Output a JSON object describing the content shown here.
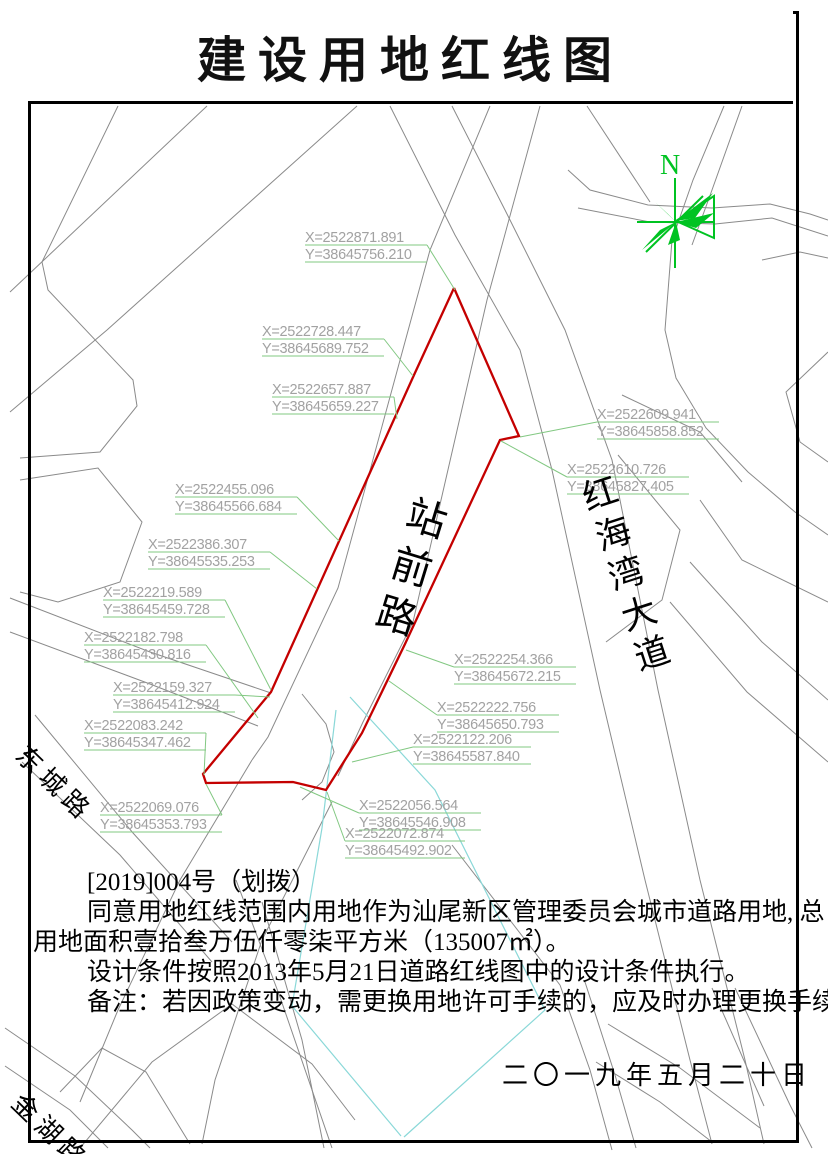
{
  "title": "建设用地红线图",
  "compass": {
    "label": "N"
  },
  "notes": {
    "lines": [
      "[2019]004号（划拨）",
      "同意用地红线范围内用地作为汕尾新区管理委员会城市道路用地, 总",
      "用地面积壹拾叁万伍仟零柒平方米（135007㎡）。",
      "设计条件按照2013年5月21日道路红线图中的设计条件执行。",
      "备注：若因政策变动，需更换用地许可手续的，应及时办理更换手续。"
    ]
  },
  "date": "二〇一九年五月二十日",
  "map": {
    "road_names": {
      "zhanqian": "站前路",
      "honghaiwan": "红海湾大道",
      "dongcheng": "东城路",
      "jinhu": "金湖路"
    },
    "colors": {
      "boundary_red": "#c40000",
      "leader_green": "#82c882",
      "road_gray": "#8a8a8a",
      "teal": "#8ad8d8",
      "compass_green": "#00c322",
      "label_gray": "#a2a2a2"
    },
    "red_boundary": [
      [
        454,
        288
      ],
      [
        519,
        436
      ],
      [
        500,
        440
      ],
      [
        405,
        644
      ],
      [
        362,
        733
      ],
      [
        326,
        790
      ],
      [
        293,
        782
      ],
      [
        206,
        783
      ],
      [
        203,
        774
      ],
      [
        271,
        692
      ],
      [
        414,
        375
      ],
      [
        454,
        288
      ]
    ],
    "roads": [
      [
        [
          118,
          106
        ],
        [
          42,
          262
        ],
        [
          48,
          290
        ],
        [
          133,
          380
        ],
        [
          137,
          406
        ],
        [
          100,
          452
        ],
        [
          20,
          458
        ]
      ],
      [
        [
          207,
          106
        ],
        [
          10,
          292
        ]
      ],
      [
        [
          357,
          106
        ],
        [
          107,
          330
        ],
        [
          10,
          412
        ]
      ],
      [
        [
          20,
          480
        ],
        [
          98,
          468
        ],
        [
          142,
          522
        ],
        [
          120,
          582
        ],
        [
          58,
          602
        ],
        [
          20,
          592
        ]
      ],
      [
        [
          490,
          106
        ],
        [
          430,
          250
        ],
        [
          338,
          588
        ],
        [
          268,
          737
        ],
        [
          252,
          760
        ]
      ],
      [
        [
          540,
          106
        ],
        [
          487,
          300
        ],
        [
          413,
          622
        ],
        [
          363,
          722
        ],
        [
          338,
          776
        ]
      ],
      [
        [
          390,
          106
        ],
        [
          455,
          235
        ],
        [
          520,
          350
        ],
        [
          552,
          470
        ],
        [
          600,
          690
        ],
        [
          645,
          880
        ],
        [
          690,
          1060
        ],
        [
          712,
          1144
        ]
      ],
      [
        [
          452,
          106
        ],
        [
          505,
          210
        ],
        [
          565,
          330
        ],
        [
          612,
          460
        ],
        [
          658,
          690
        ],
        [
          700,
          880
        ],
        [
          745,
          1060
        ],
        [
          764,
          1144
        ]
      ],
      [
        [
          568,
          170
        ],
        [
          590,
          190
        ],
        [
          648,
          205
        ],
        [
          712,
          208
        ],
        [
          770,
          204
        ],
        [
          810,
          214
        ],
        [
          828,
          220
        ]
      ],
      [
        [
          578,
          208
        ],
        [
          650,
          222
        ],
        [
          715,
          224
        ],
        [
          772,
          218
        ],
        [
          828,
          236
        ]
      ],
      [
        [
          724,
          106
        ],
        [
          693,
          180
        ],
        [
          672,
          240
        ],
        [
          665,
          330
        ],
        [
          676,
          378
        ],
        [
          706,
          428
        ],
        [
          748,
          472
        ],
        [
          795,
          512
        ],
        [
          828,
          535
        ]
      ],
      [
        [
          742,
          106
        ],
        [
          712,
          190
        ],
        [
          692,
          245
        ]
      ],
      [
        [
          587,
          106
        ],
        [
          650,
          202
        ]
      ],
      [
        [
          762,
          260
        ],
        [
          800,
          252
        ],
        [
          828,
          258
        ]
      ],
      [
        [
          622,
          395
        ],
        [
          700,
          432
        ],
        [
          742,
          482
        ]
      ],
      [
        [
          618,
          455
        ],
        [
          680,
          530
        ],
        [
          662,
          600
        ],
        [
          606,
          642
        ]
      ],
      [
        [
          700,
          500
        ],
        [
          742,
          560
        ],
        [
          828,
          602
        ]
      ],
      [
        [
          690,
          562
        ],
        [
          762,
          642
        ],
        [
          828,
          700
        ]
      ],
      [
        [
          670,
          602
        ],
        [
          747,
          692
        ],
        [
          828,
          762
        ]
      ],
      [
        [
          828,
          352
        ],
        [
          786,
          392
        ],
        [
          800,
          442
        ],
        [
          828,
          462
        ]
      ],
      [
        [
          10,
          598
        ],
        [
          150,
          652
        ],
        [
          271,
          693
        ]
      ],
      [
        [
          10,
          632
        ],
        [
          150,
          684
        ],
        [
          258,
          726
        ]
      ],
      [
        [
          35,
          715
        ],
        [
          133,
          833
        ],
        [
          232,
          942
        ]
      ],
      [
        [
          22,
          762
        ],
        [
          120,
          855
        ],
        [
          212,
          962
        ]
      ],
      [
        [
          302,
          694
        ],
        [
          326,
          724
        ],
        [
          334,
          752
        ],
        [
          322,
          782
        ],
        [
          302,
          800
        ]
      ],
      [
        [
          252,
          760
        ],
        [
          180,
          880
        ],
        [
          118,
          1010
        ],
        [
          80,
          1102
        ]
      ],
      [
        [
          332,
          802
        ],
        [
          262,
          940
        ],
        [
          215,
          1080
        ],
        [
          202,
          1144
        ]
      ],
      [
        [
          60,
          1092
        ],
        [
          102,
          1048
        ],
        [
          146,
          1072
        ],
        [
          190,
          1144
        ]
      ],
      [
        [
          80,
          1148
        ],
        [
          152,
          1062
        ],
        [
          232,
          1004
        ],
        [
          312,
          1064
        ],
        [
          355,
          1120
        ]
      ],
      [
        [
          5,
          1028
        ],
        [
          75,
          1076
        ],
        [
          132,
          1130
        ],
        [
          150,
          1148
        ]
      ],
      [
        [
          5,
          1066
        ],
        [
          70,
          1110
        ],
        [
          108,
          1148
        ]
      ],
      [
        [
          236,
          880
        ],
        [
          280,
          997
        ],
        [
          332,
          1148
        ]
      ],
      [
        [
          262,
          902
        ],
        [
          302,
          1040
        ],
        [
          324,
          1148
        ]
      ],
      [
        [
          452,
          845
        ],
        [
          560,
          985
        ]
      ],
      [
        [
          560,
          985
        ],
        [
          590,
          1070
        ],
        [
          612,
          1150
        ]
      ],
      [
        [
          585,
          982
        ],
        [
          615,
          1075
        ],
        [
          636,
          1148
        ]
      ],
      [
        [
          596,
          1062
        ],
        [
          660,
          1102
        ],
        [
          712,
          1142
        ]
      ],
      [
        [
          608,
          1024
        ],
        [
          680,
          1068
        ],
        [
          760,
          1128
        ]
      ],
      [
        [
          712,
          988
        ],
        [
          764,
          1106
        ]
      ],
      [
        [
          735,
          988
        ],
        [
          790,
          1105
        ],
        [
          812,
          1148
        ]
      ]
    ],
    "teal_lines": [
      [
        [
          350,
          697
        ],
        [
          435,
          790
        ],
        [
          545,
          1010
        ],
        [
          404,
          1137
        ]
      ],
      [
        [
          322,
          828
        ],
        [
          292,
          1006
        ],
        [
          401,
          1136
        ]
      ],
      [
        [
          336,
          710
        ],
        [
          322,
          828
        ]
      ]
    ],
    "coordinate_labels": [
      {
        "x": "X=2522871.891",
        "y": "Y=38645756.210",
        "lx": 305,
        "ly": 228,
        "w": 122,
        "tx": 455,
        "ty": 290,
        "side": "right"
      },
      {
        "x": "X=2522728.447",
        "y": "Y=38645689.752",
        "lx": 262,
        "ly": 322,
        "w": 122,
        "tx": 413,
        "ty": 376,
        "side": "right"
      },
      {
        "x": "X=2522657.887",
        "y": "Y=38645659.227",
        "lx": 272,
        "ly": 380,
        "w": 122,
        "tx": 397,
        "ty": 419,
        "side": "right"
      },
      {
        "x": "X=2522609.941",
        "y": "Y=38645858.852",
        "lx": 597,
        "ly": 405,
        "w": 122,
        "tx": 520,
        "ty": 437,
        "side": "left"
      },
      {
        "x": "X=2522610.726",
        "y": "Y=38645827.405",
        "lx": 567,
        "ly": 460,
        "w": 122,
        "tx": 501,
        "ty": 441,
        "side": "left"
      },
      {
        "x": "X=2522455.096",
        "y": "Y=38645566.684",
        "lx": 175,
        "ly": 480,
        "w": 122,
        "tx": 339,
        "ty": 541,
        "side": "right"
      },
      {
        "x": "X=2522386.307",
        "y": "Y=38645535.253",
        "lx": 148,
        "ly": 535,
        "w": 122,
        "tx": 317,
        "ty": 589,
        "side": "right"
      },
      {
        "x": "X=2522219.589",
        "y": "Y=38645459.728",
        "lx": 103,
        "ly": 583,
        "w": 122,
        "tx": 271,
        "ty": 690,
        "side": "right"
      },
      {
        "x": "X=2522182.798",
        "y": "Y=38645430.816",
        "lx": 84,
        "ly": 628,
        "w": 122,
        "tx": 258,
        "ty": 718,
        "side": "right"
      },
      {
        "x": "X=2522159.327",
        "y": "Y=38645412.924",
        "lx": 113,
        "ly": 678,
        "w": 122,
        "tx": 270,
        "ty": 697,
        "side": "right"
      },
      {
        "x": "X=2522083.242",
        "y": "Y=38645347.462",
        "lx": 84,
        "ly": 716,
        "w": 122,
        "tx": 204,
        "ty": 775,
        "side": "right"
      },
      {
        "x": "X=2522069.076",
        "y": "Y=38645353.793",
        "lx": 100,
        "ly": 798,
        "w": 122,
        "tx": 206,
        "ty": 784,
        "side": "right"
      },
      {
        "x": "X=2522254.366",
        "y": "Y=38645672.215",
        "lx": 454,
        "ly": 650,
        "w": 122,
        "tx": 406,
        "ty": 650,
        "side": "left"
      },
      {
        "x": "X=2522222.756",
        "y": "Y=38645650.793",
        "lx": 437,
        "ly": 698,
        "w": 122,
        "tx": 389,
        "ty": 681,
        "side": "left"
      },
      {
        "x": "X=2522122.206",
        "y": "Y=38645587.840",
        "lx": 413,
        "ly": 730,
        "w": 118,
        "tx": 352,
        "ty": 762,
        "side": "left"
      },
      {
        "x": "X=2522056.564",
        "y": "Y=38645546.908",
        "lx": 359,
        "ly": 796,
        "w": 122,
        "tx": 300,
        "ty": 787,
        "side": "left"
      },
      {
        "x": "X=2522072.874",
        "y": "Y=38645492.902",
        "lx": 345,
        "ly": 824,
        "w": 120,
        "tx": 327,
        "ty": 792,
        "side": "left"
      }
    ]
  }
}
